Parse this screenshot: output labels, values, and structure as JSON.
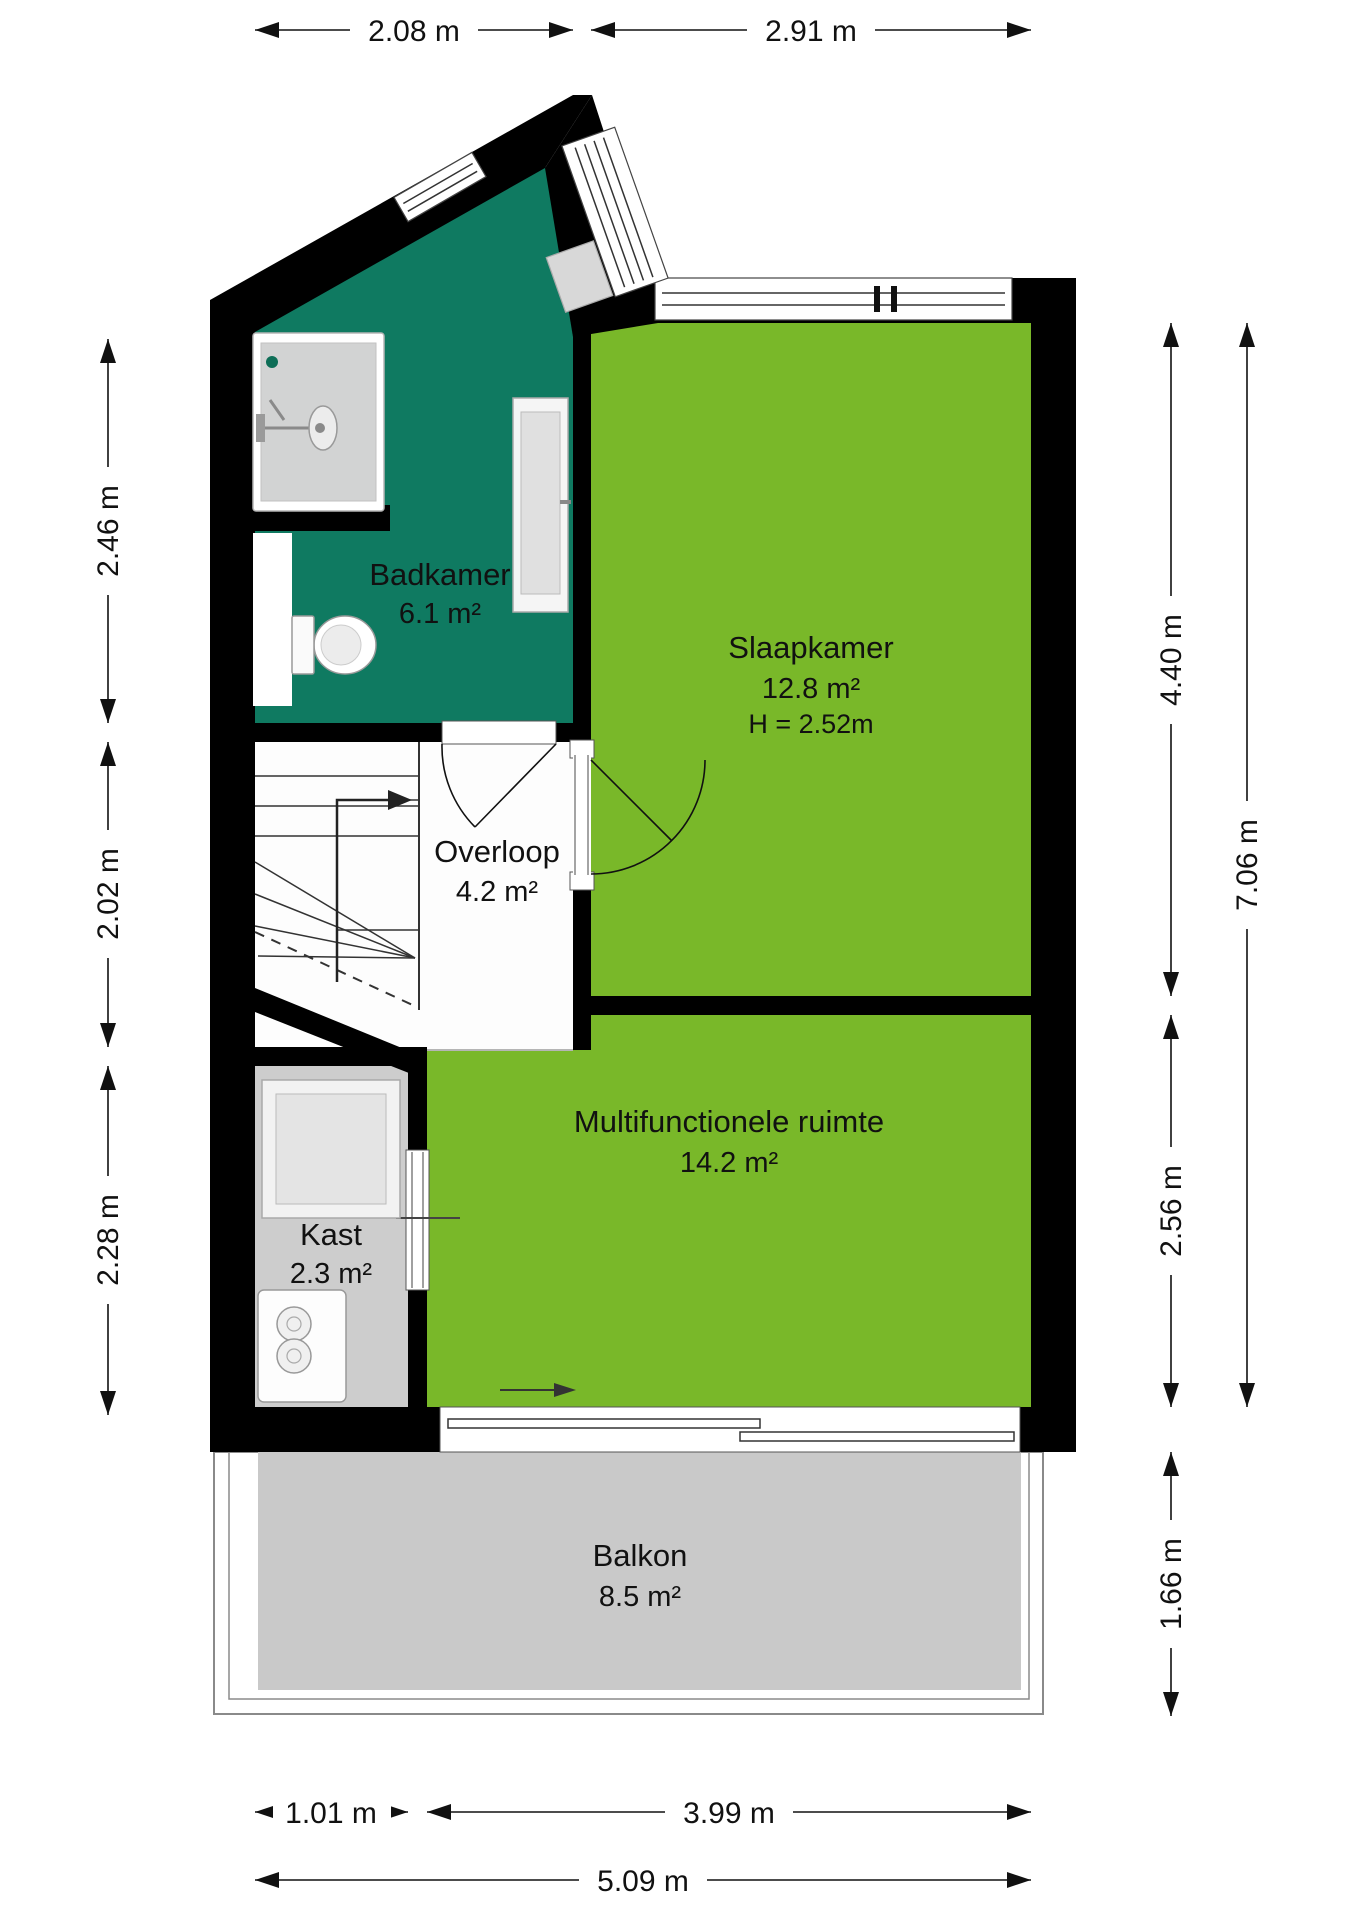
{
  "plan": {
    "type": "floorplan",
    "rooms": {
      "badkamer": {
        "name": "Badkamer",
        "area": "6.1 m²"
      },
      "slaapkamer": {
        "name": "Slaapkamer",
        "area": "12.8 m²",
        "ceiling_height": "H = 2.52m"
      },
      "overloop": {
        "name": "Overloop",
        "area": "4.2 m²"
      },
      "kast": {
        "name": "Kast",
        "area": "2.3 m²"
      },
      "multifunctionele_ruimte": {
        "name": "Multifunctionele ruimte",
        "area": "14.2 m²"
      },
      "balkon": {
        "name": "Balkon",
        "area": "8.5 m²"
      }
    },
    "dimensions": {
      "top": [
        "2.08 m",
        "2.91 m"
      ],
      "left": [
        "2.46 m",
        "2.02 m",
        "2.28 m"
      ],
      "right_inner": [
        "4.40 m",
        "2.56 m",
        "1.66 m"
      ],
      "right_outer": [
        "7.06 m"
      ],
      "bottom": [
        "1.01 m",
        "3.99 m",
        "5.09 m"
      ]
    },
    "colors": {
      "room_green": "#79b829",
      "room_teal": "#0f7a61",
      "floor_gray": "#cdcdcd",
      "balcony_gray": "#c9c9c9",
      "wall_black": "#000000"
    }
  }
}
